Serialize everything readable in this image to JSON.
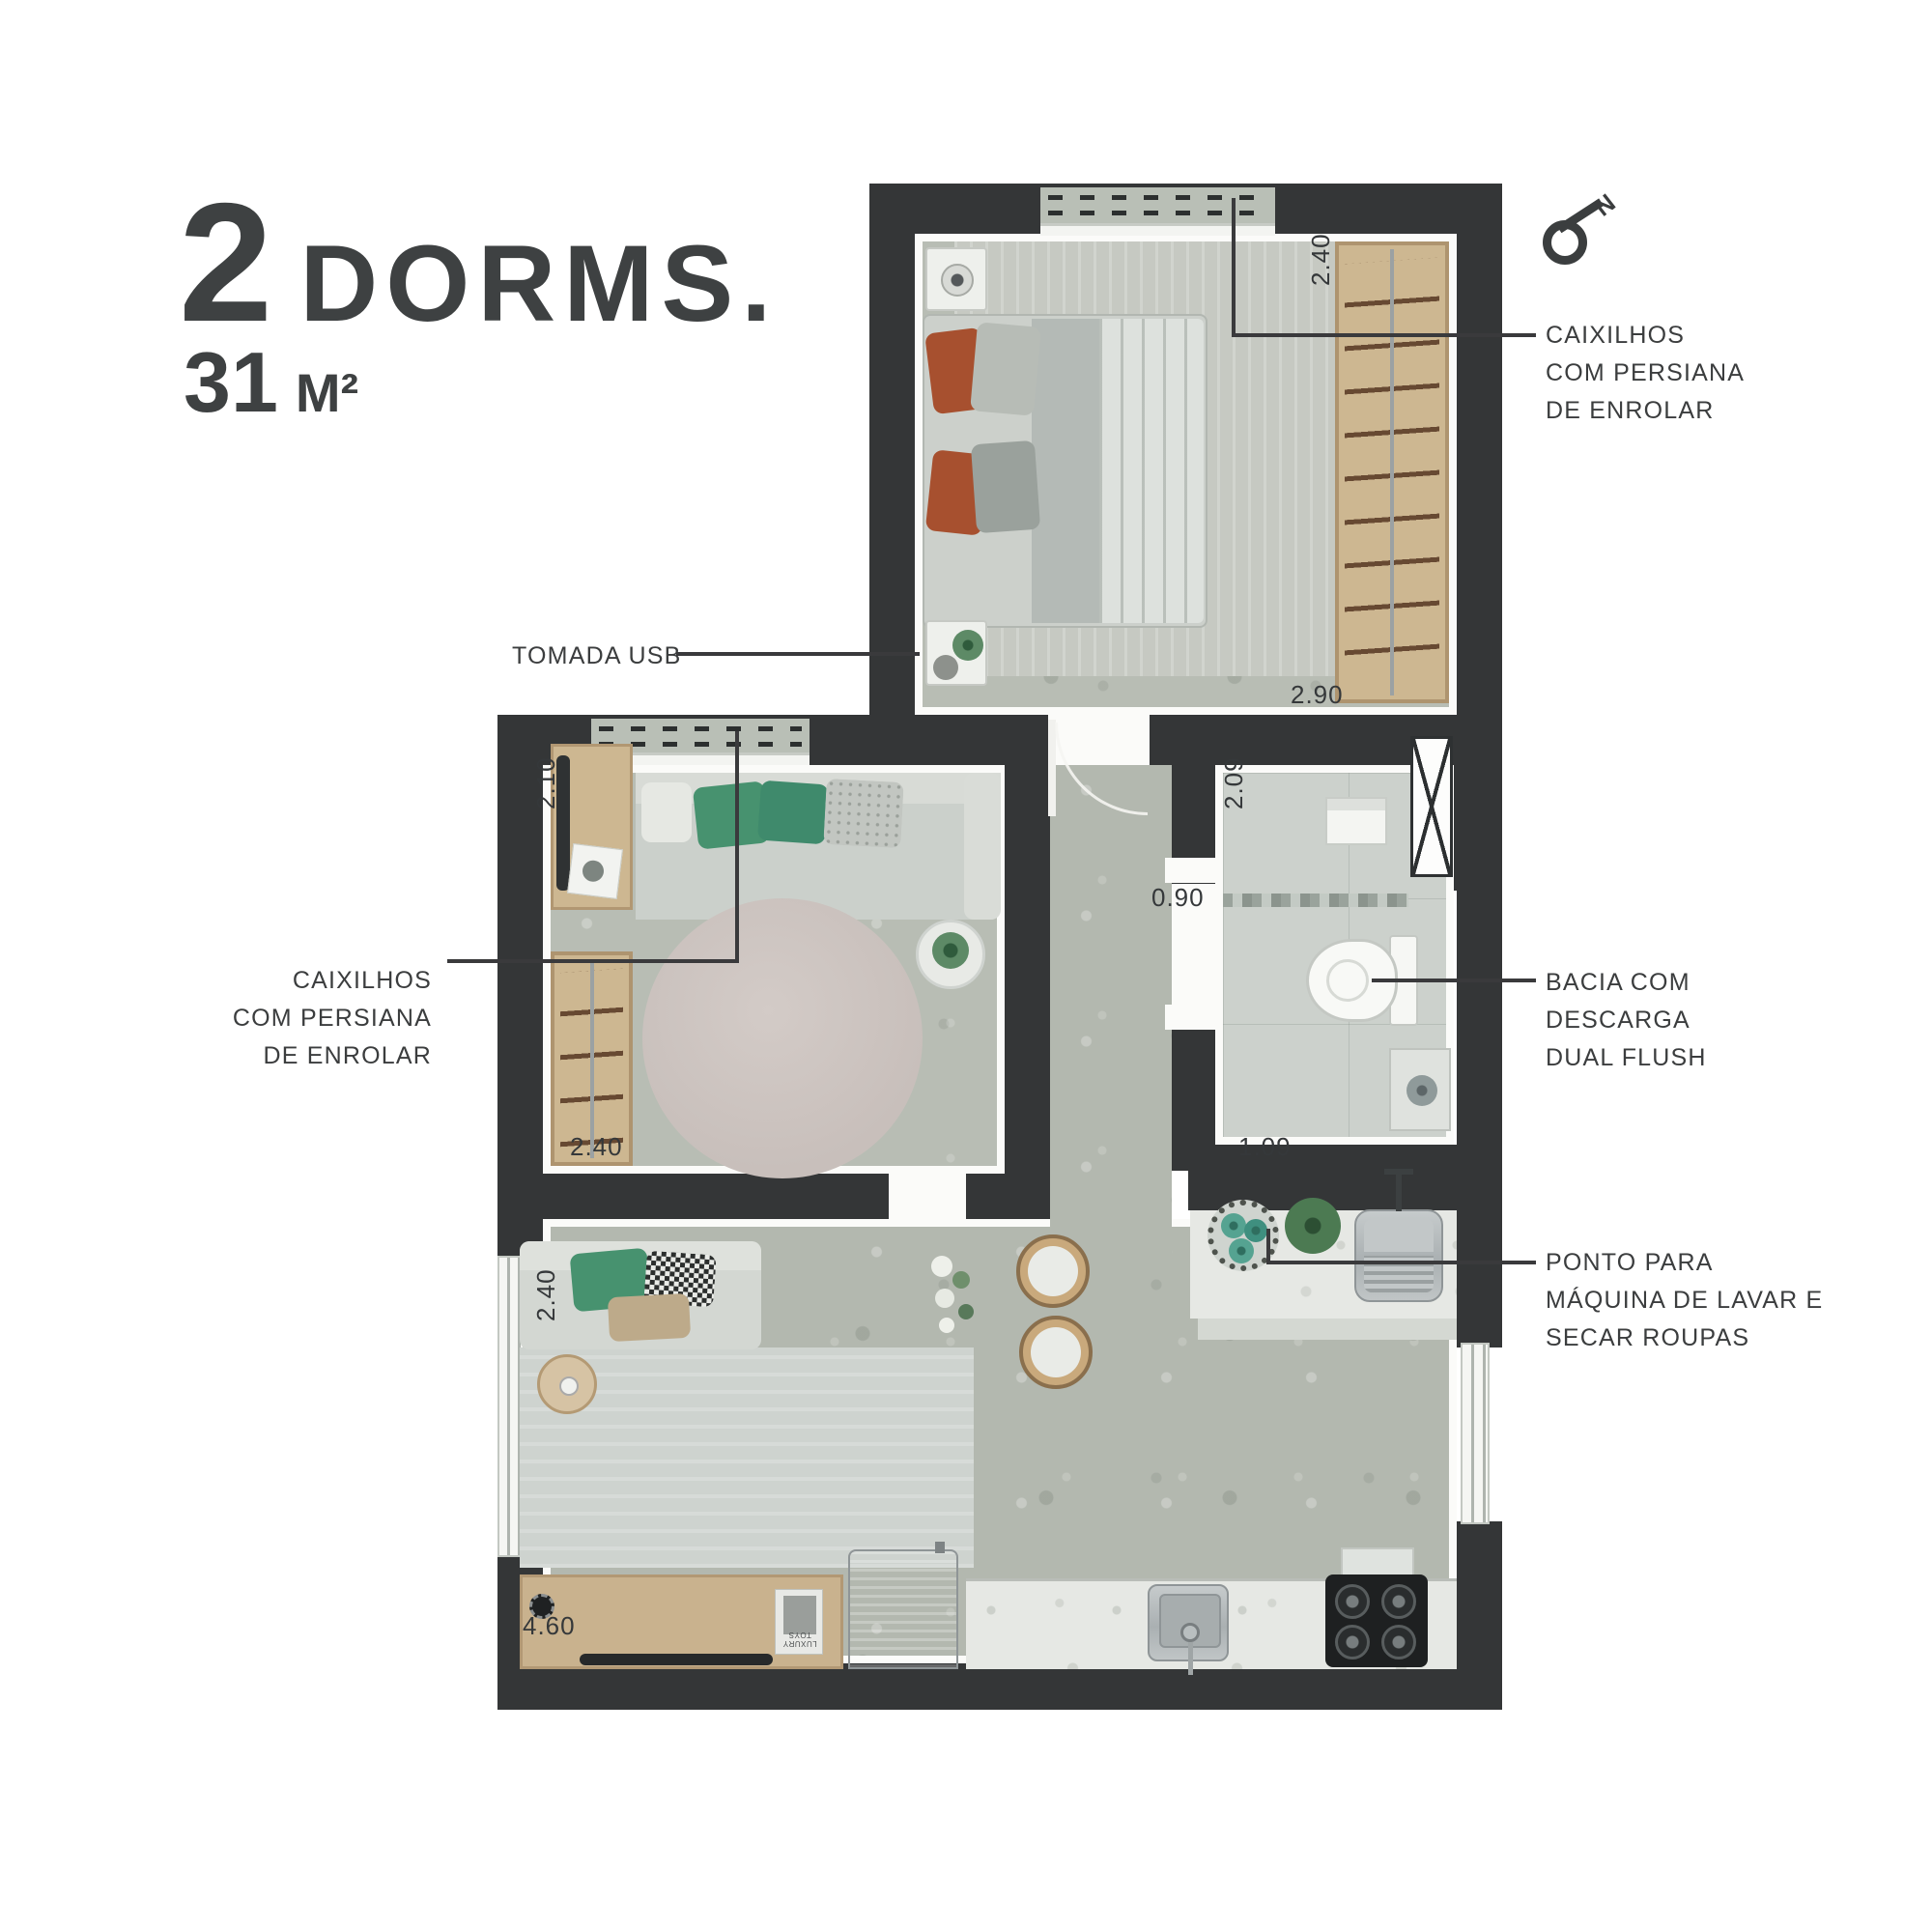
{
  "header": {
    "units": "2",
    "units_label": "DORMS.",
    "area_value": "31",
    "area_unit": "M²"
  },
  "compass": {
    "north": "N"
  },
  "callouts": {
    "window_right": {
      "lines": [
        "CAIXILHOS",
        "COM PERSIANA",
        "DE ENROLAR"
      ]
    },
    "usb": {
      "lines": [
        "TOMADA USB"
      ]
    },
    "window_left": {
      "lines": [
        "CAIXILHOS",
        "COM PERSIANA",
        "DE ENROLAR"
      ]
    },
    "toilet": {
      "lines": [
        "BACIA COM",
        "DESCARGA",
        "DUAL FLUSH"
      ]
    },
    "laundry": {
      "lines": [
        "PONTO PARA",
        "MÁQUINA DE LAVAR E",
        "SECAR ROUPAS"
      ]
    }
  },
  "dimensions": {
    "bedroom_top": "2.40",
    "bedroom_bottom": "2.90",
    "living_left": "2.10",
    "hall": "0.90",
    "bath_top": "2.09",
    "living_bottom": "2.40",
    "bath_bottom": "1.09",
    "lower_left": "2.40",
    "kitchen_bottom": "4.60"
  },
  "decor": {
    "book_title": "LUXURY TOYS"
  },
  "colors": {
    "wall": "#343637",
    "ink": "#3b3d3e",
    "leader": "#3a3a3c",
    "floor": "#b3b8af",
    "floor2": "#b8bdb4",
    "tile": "#ccd1cc",
    "wood": "#cdb791",
    "wood_dark": "#b79e78",
    "marble": "#e6e8e4",
    "rug": "#c6c9c2",
    "rug_round": "#c8bfbb",
    "steel": "#b4babb",
    "green": "#47926f",
    "orange": "#a7502f"
  }
}
